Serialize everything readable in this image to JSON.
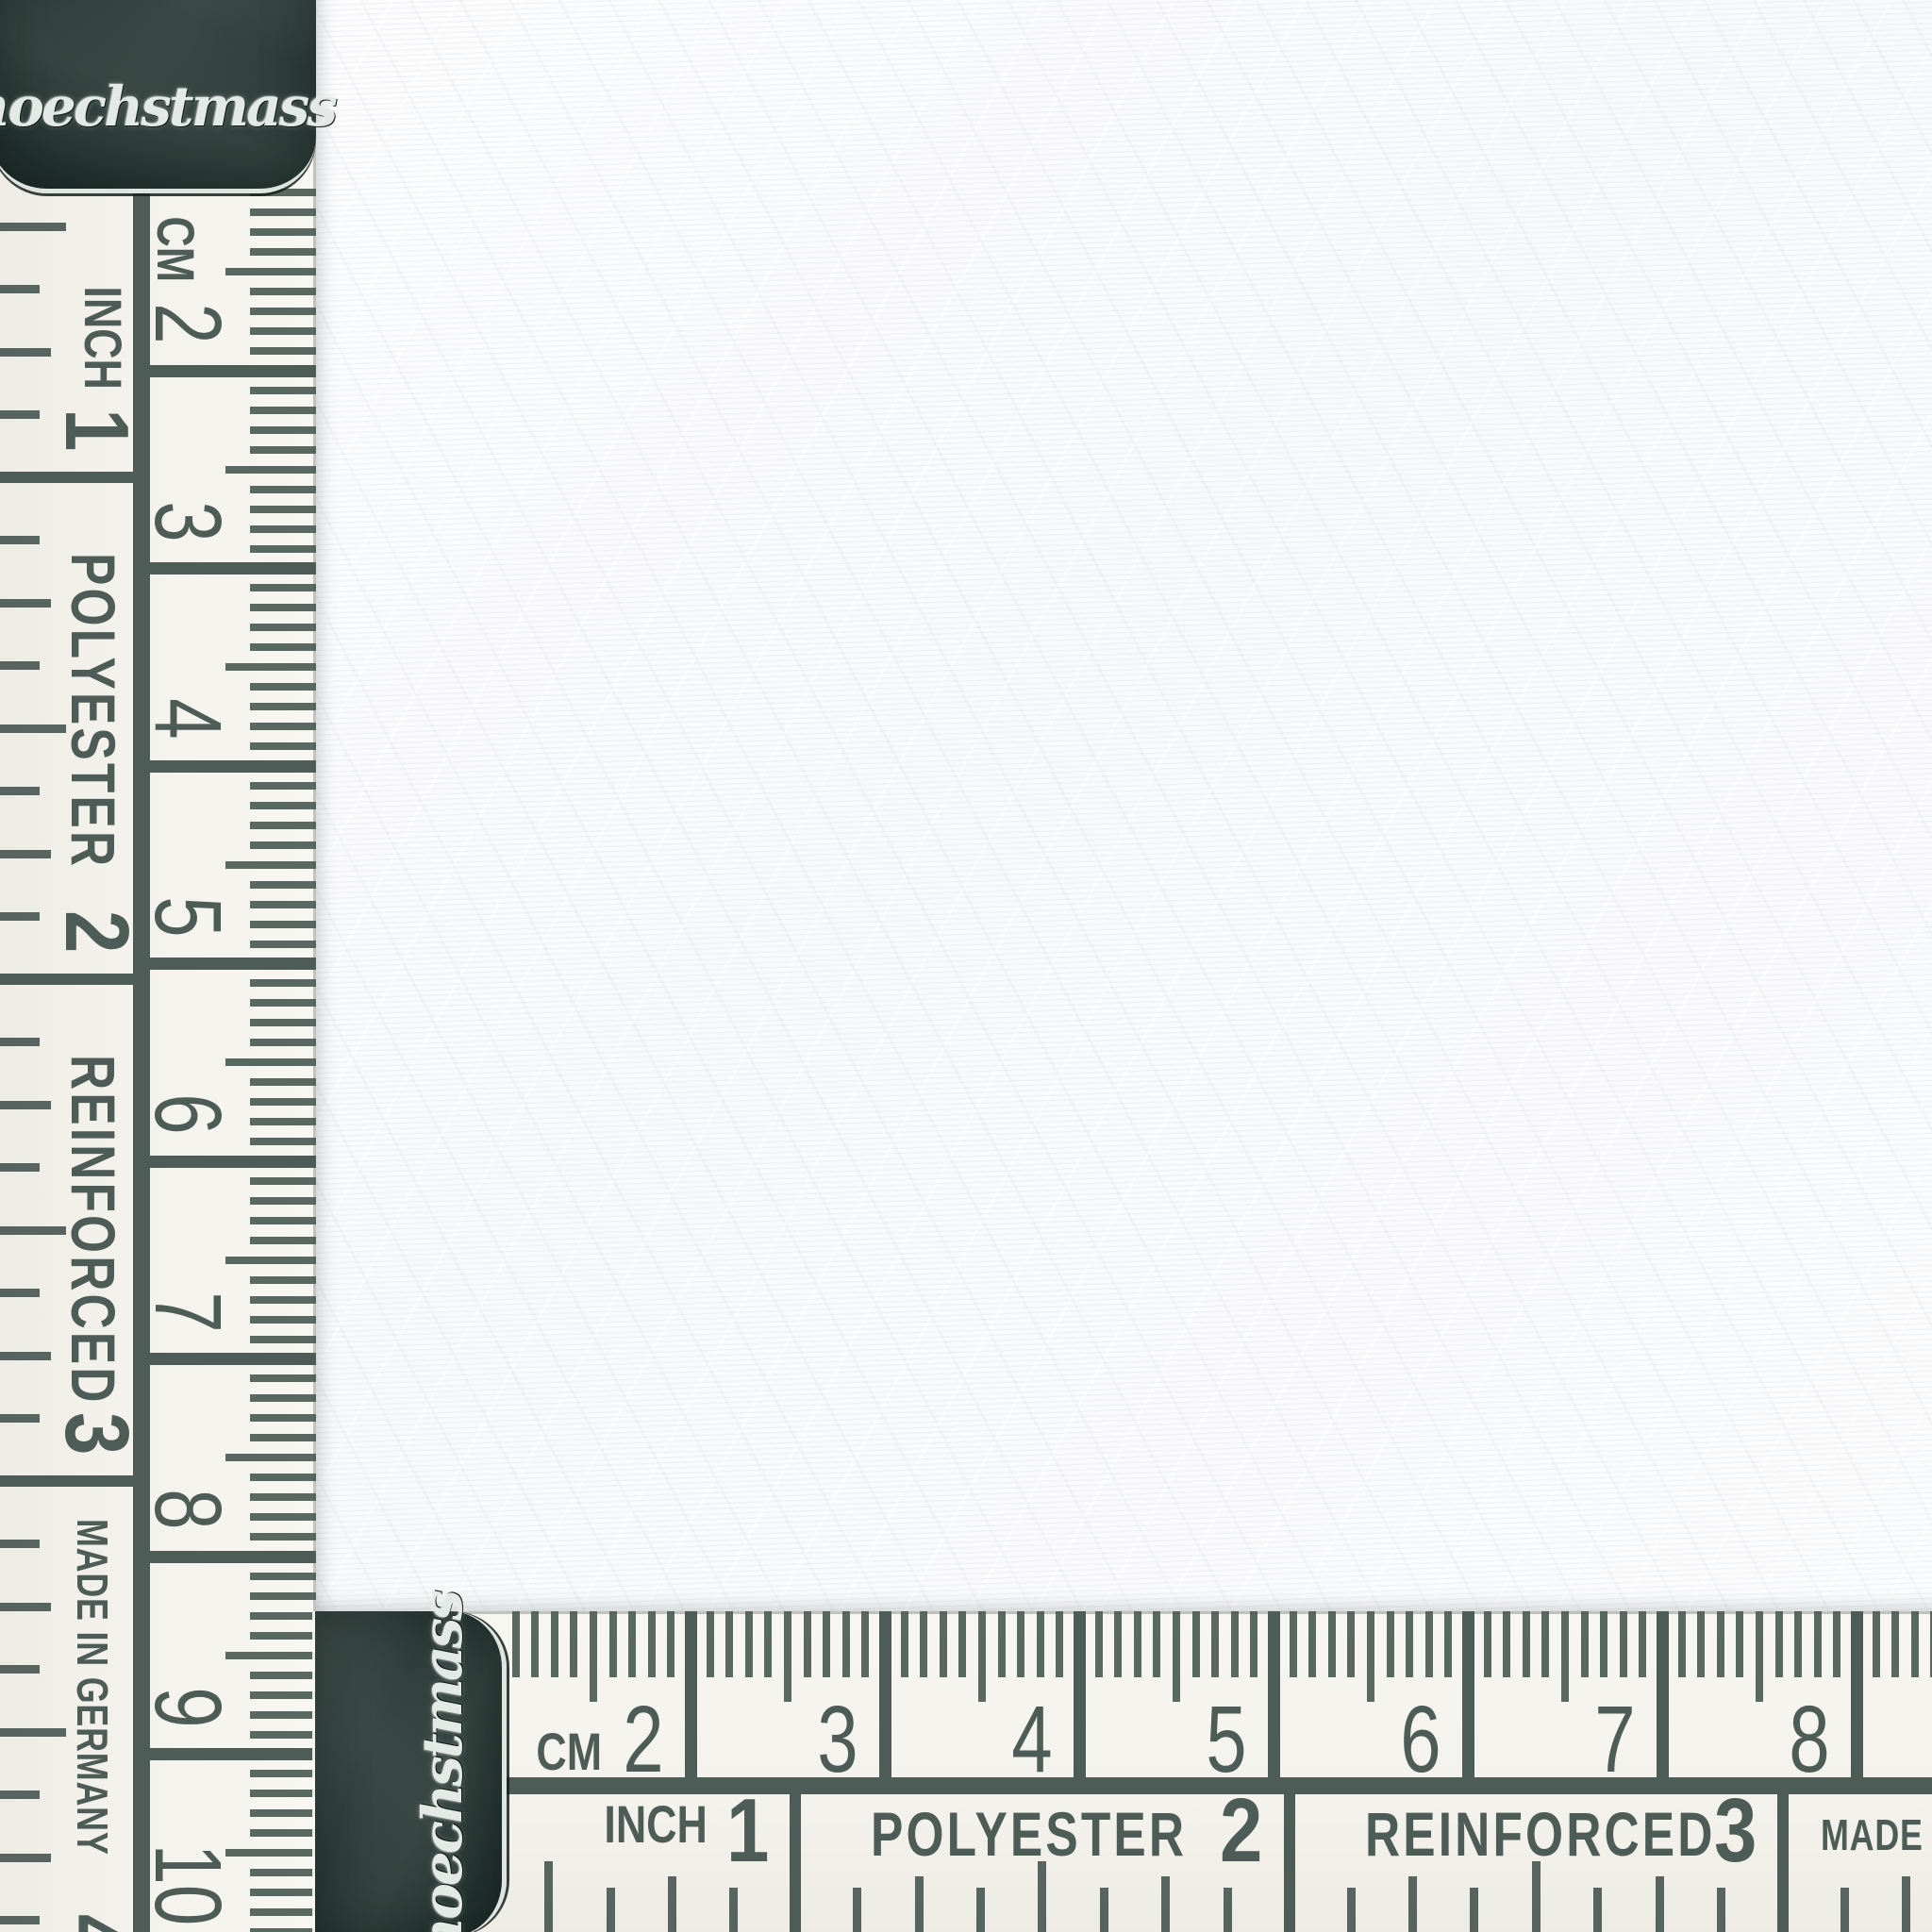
{
  "scene": {
    "description": "white fabric swatch photographed with two hoechstmass tape measures along the left and bottom edges"
  },
  "fabric": {
    "color": "#fbfcfd"
  },
  "tape": {
    "brand_script": "hoechstmass",
    "cm_scale": {
      "unit_label": "CM",
      "numbers": [
        "2",
        "3",
        "4",
        "5",
        "6",
        "7",
        "8",
        "9",
        "10"
      ]
    },
    "inch_scale": {
      "unit_label": "INCH",
      "numbers": [
        "1",
        "2",
        "3",
        "4"
      ],
      "segment_words": [
        "",
        "POLYESTER",
        "REINFORCED",
        "MADE IN GERMANY"
      ]
    },
    "colors": {
      "ink": "#4e5c57",
      "tape_face": "#f4f2ec",
      "cap_dark": "#263431",
      "cap_rim": "#dee4df",
      "brand_silver": "#e3e9e4"
    }
  }
}
